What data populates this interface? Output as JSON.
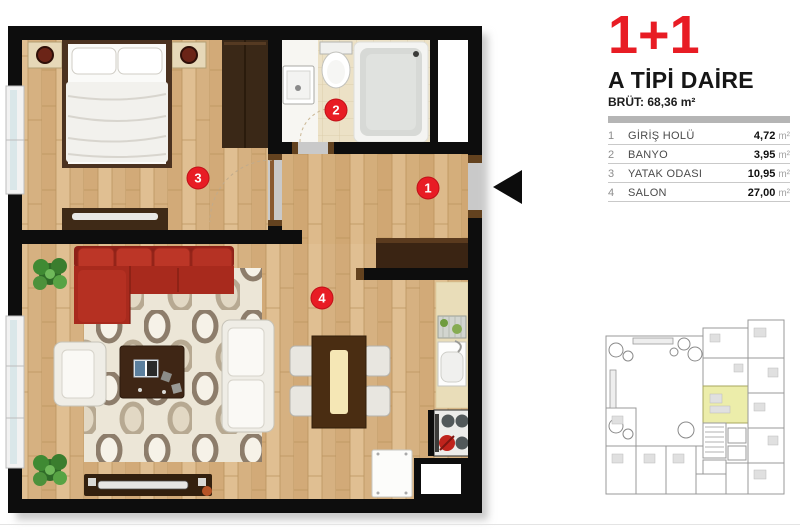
{
  "legend": {
    "title": "1+1",
    "subtitle": "A TİPİ DAİRE",
    "gross_label": "BRÜT:",
    "gross_value": "68,36 m²",
    "rooms": [
      {
        "no": "1",
        "name": "GİRİŞ HOLÜ",
        "area": "4,72",
        "unit": "m²"
      },
      {
        "no": "2",
        "name": "BANYO",
        "area": "3,95",
        "unit": "m²"
      },
      {
        "no": "3",
        "name": "YATAK ODASI",
        "area": "10,95",
        "unit": "m²"
      },
      {
        "no": "4",
        "name": "SALON",
        "area": "27,00",
        "unit": "m²"
      }
    ],
    "accent_color": "#e81c24"
  },
  "floorplan": {
    "badge_color": "#e81c24",
    "badges": [
      {
        "no": "1",
        "room": "GİRİŞ HOLÜ"
      },
      {
        "no": "2",
        "room": "BANYO"
      },
      {
        "no": "3",
        "room": "YATAK ODASI"
      },
      {
        "no": "4",
        "room": "SALON"
      }
    ]
  },
  "siteplan": {
    "highlight_color": "#ecedaa"
  }
}
